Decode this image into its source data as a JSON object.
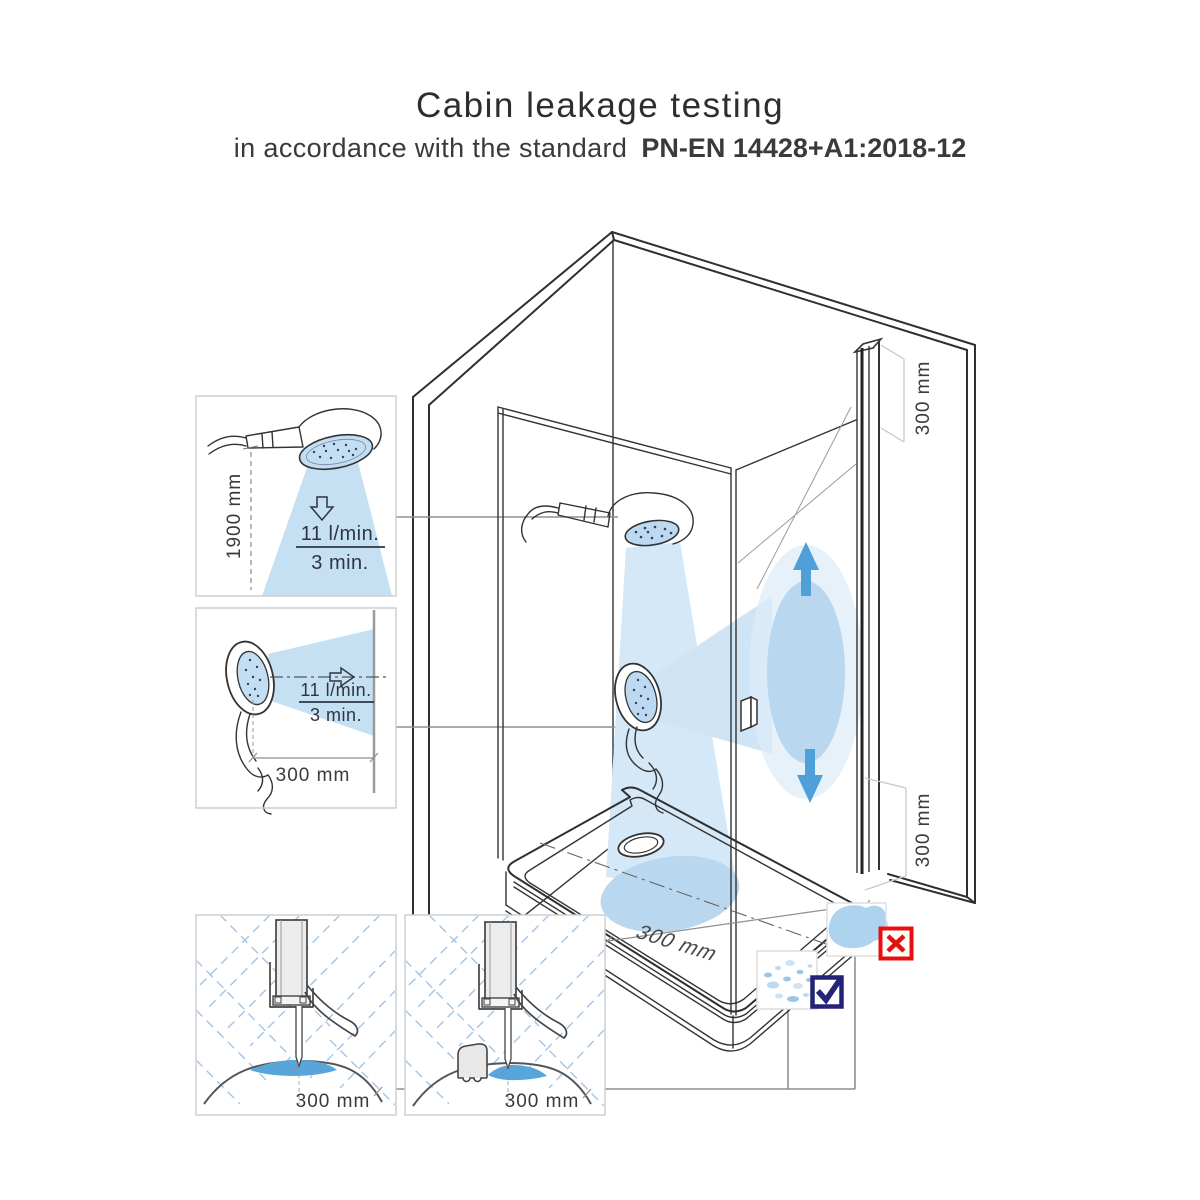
{
  "title": "Cabin leakage testing",
  "subtitle": {
    "prefix": "in accordance with the standard",
    "standard": "PN-EN 14428+A1:2018-12"
  },
  "insets": {
    "overhead_spray": {
      "height_label": "1900 mm",
      "flow_label": "11 l/min.",
      "duration_label": "3 min."
    },
    "horizontal_spray": {
      "distance_label": "300 mm",
      "flow_label": "11 l/min.",
      "duration_label": "3 min."
    },
    "seal_plain": {
      "distance_label": "300 mm"
    },
    "seal_threshold": {
      "distance_label": "300 mm"
    }
  },
  "cabin": {
    "top_gap_label": "300 mm",
    "bottom_gap_label": "300 mm",
    "tray_distance_label": "300 mm"
  },
  "icons": {
    "fail": "x-icon",
    "pass": "check-icon"
  },
  "colors": {
    "spray_light": "#d5e8f7",
    "spray_medium": "#b9d8ef",
    "water_blue": "#58a5dc",
    "arrow_blue": "#4f9fd9",
    "fail_red": "#e8100c",
    "pass_navy": "#232378"
  }
}
